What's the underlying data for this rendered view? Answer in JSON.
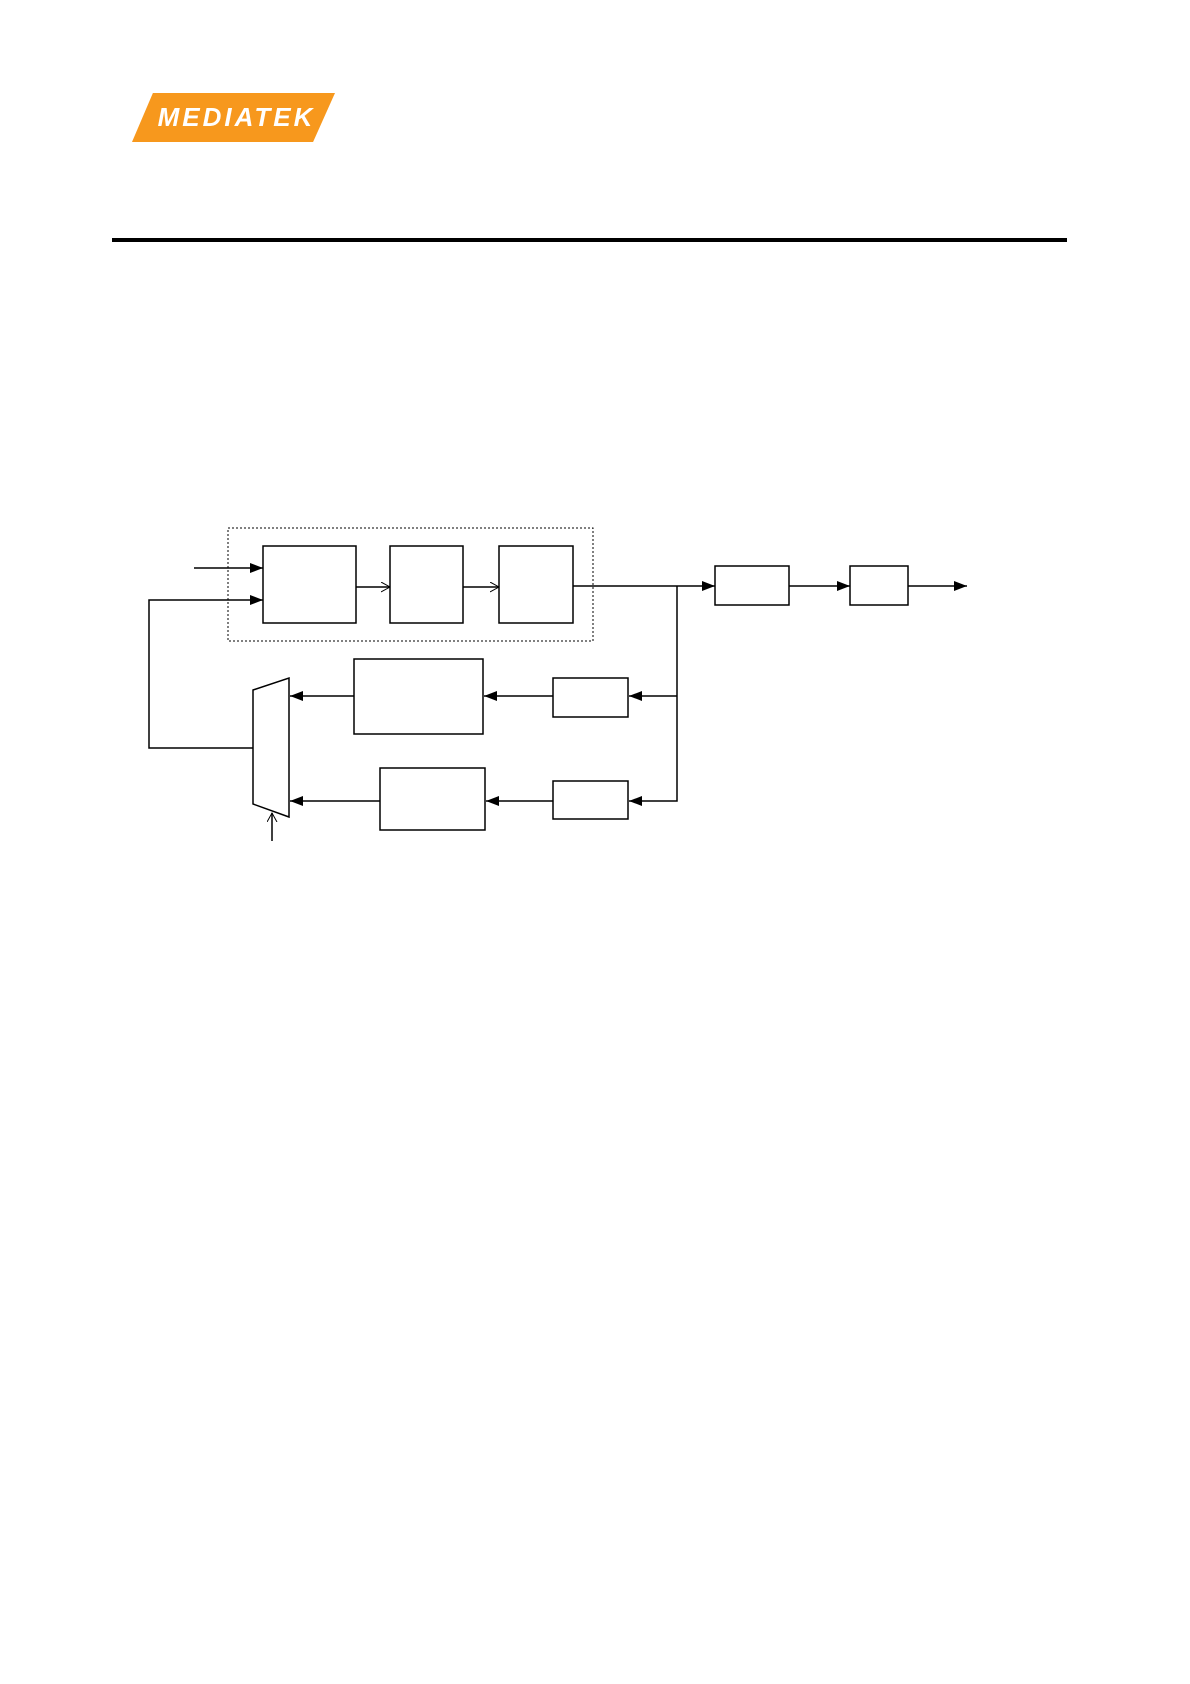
{
  "page": {
    "width": 1190,
    "height": 1684,
    "background_color": "#ffffff"
  },
  "header": {
    "logo_text": "MEDIATEK",
    "logo_color": "#F7981D",
    "logo_text_color": "#ffffff",
    "divider_color": "#000000"
  },
  "diagram": {
    "kind": "block-diagram",
    "stroke_color": "#000000",
    "box_fill": "#ffffff",
    "dashed_group_label": "",
    "blocks": [
      {
        "id": "pipeline-box-1",
        "label": ""
      },
      {
        "id": "pipeline-box-2",
        "label": ""
      },
      {
        "id": "pipeline-box-3",
        "label": ""
      },
      {
        "id": "output-box-1",
        "label": ""
      },
      {
        "id": "output-box-2",
        "label": ""
      },
      {
        "id": "middle-branch-large-box",
        "label": ""
      },
      {
        "id": "middle-branch-small-box",
        "label": ""
      },
      {
        "id": "bottom-branch-large-box",
        "label": ""
      },
      {
        "id": "bottom-branch-small-box",
        "label": ""
      },
      {
        "id": "mux",
        "shape": "trapezoid",
        "label": ""
      }
    ],
    "connections": [
      "external-input -> pipeline-box-1 (upper input, solid arrowhead)",
      "mux-output -> feedback wire -> pipeline-box-1 (lower input, solid arrowhead)",
      "pipeline-box-1 -> pipeline-box-2 (open arrowhead)",
      "pipeline-box-2 -> pipeline-box-3 (open arrowhead)",
      "pipeline-box-3 -> output-box-1 (solid arrowhead, tap junction on the way)",
      "output-box-1 -> output-box-2 (solid arrowhead)",
      "output-box-2 -> external output (solid arrowhead)",
      "tap junction -> middle-branch-small-box -> middle-branch-large-box -> mux input 1",
      "tap junction -> bottom-branch-small-box -> bottom-branch-large-box -> mux input 2",
      "select line -> mux bottom edge (open arrowhead, from below)"
    ]
  }
}
